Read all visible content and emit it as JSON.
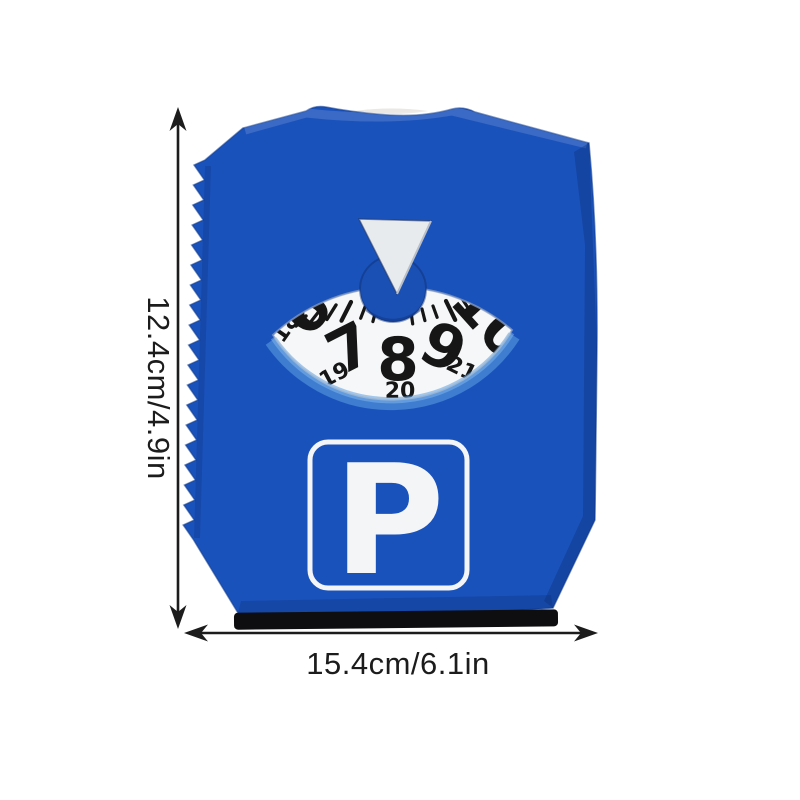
{
  "product": {
    "kind": "parking-disc-ice-scraper",
    "dial": {
      "pointer": "triangle-down",
      "large_numbers": [
        "6",
        "7",
        "8",
        "9",
        "10"
      ],
      "small_numbers": [
        "18",
        "19",
        "20",
        "21"
      ]
    },
    "sign_letter": "P"
  },
  "annotations": {
    "height_label": "12.4cm/4.9in",
    "width_label": "15.4cm/6.1in"
  },
  "colors": {
    "body_blue": "#1a52bc",
    "body_blue_dark": "#0c2c70",
    "dial_face": "#f5f7f8",
    "number_black": "#161616",
    "sign_white": "#f3f5f7",
    "pointer_gray": "#e8ebee",
    "glow_blue": "#5fa0e2",
    "strip_black": "#0e0e11",
    "annotation_black": "#1c1c1c"
  }
}
